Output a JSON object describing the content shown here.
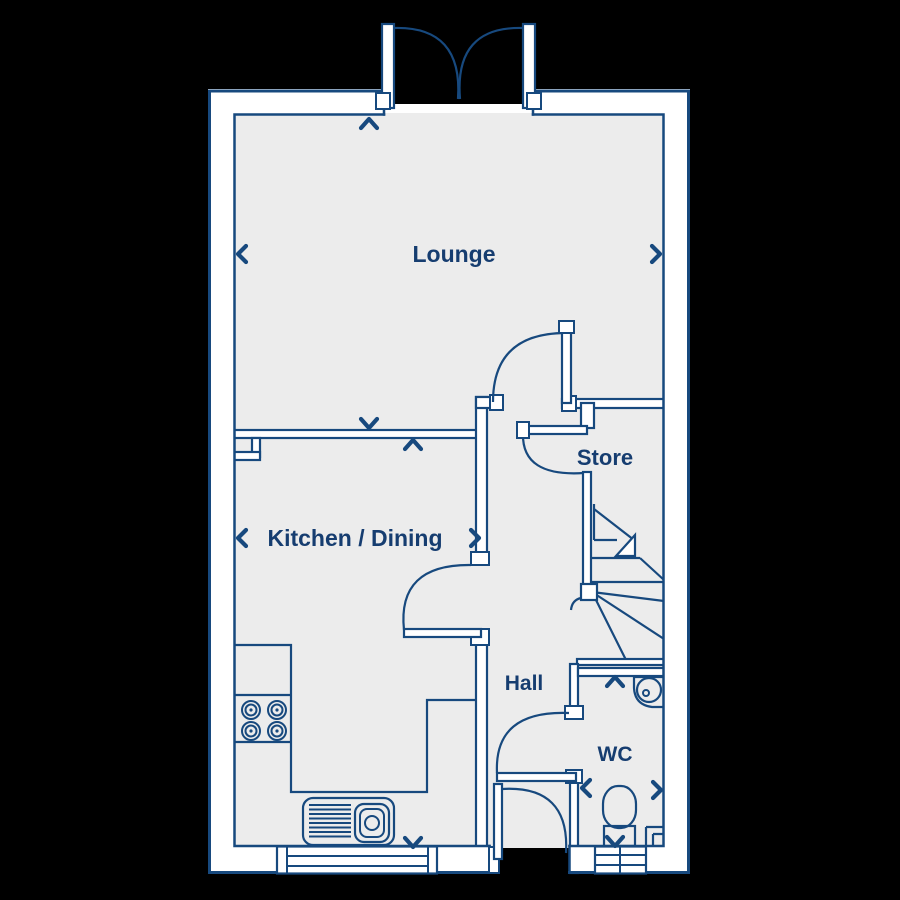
{
  "page": {
    "background_color": "#000000",
    "type": "ground-floor-plan"
  },
  "floor_plan": {
    "rooms": {
      "lounge": {
        "label": "Lounge"
      },
      "kitchen_dining": {
        "label": "Kitchen / Dining"
      },
      "store": {
        "label": "Store"
      },
      "hall": {
        "label": "Hall"
      },
      "wc": {
        "label": "WC"
      }
    },
    "fixtures": [
      "french-doors",
      "lounge-door",
      "kitchen-door",
      "store-door",
      "wc-door",
      "front-door",
      "winder-stairs",
      "stairs-direction-arrow",
      "kitchen-counter",
      "hob",
      "sink-drainer",
      "kitchen-window",
      "wc-window",
      "toilet",
      "corner-basin",
      "pipe-boxing"
    ],
    "dimension_arrows": [
      "chevron-up",
      "chevron-down",
      "chevron-left",
      "chevron-right"
    ],
    "colors": {
      "line": "#17497E",
      "wall_fill": "#FFFFFF",
      "floor_fill": "#ECECEC",
      "label_text": "#163D70",
      "background": "#000000"
    }
  }
}
